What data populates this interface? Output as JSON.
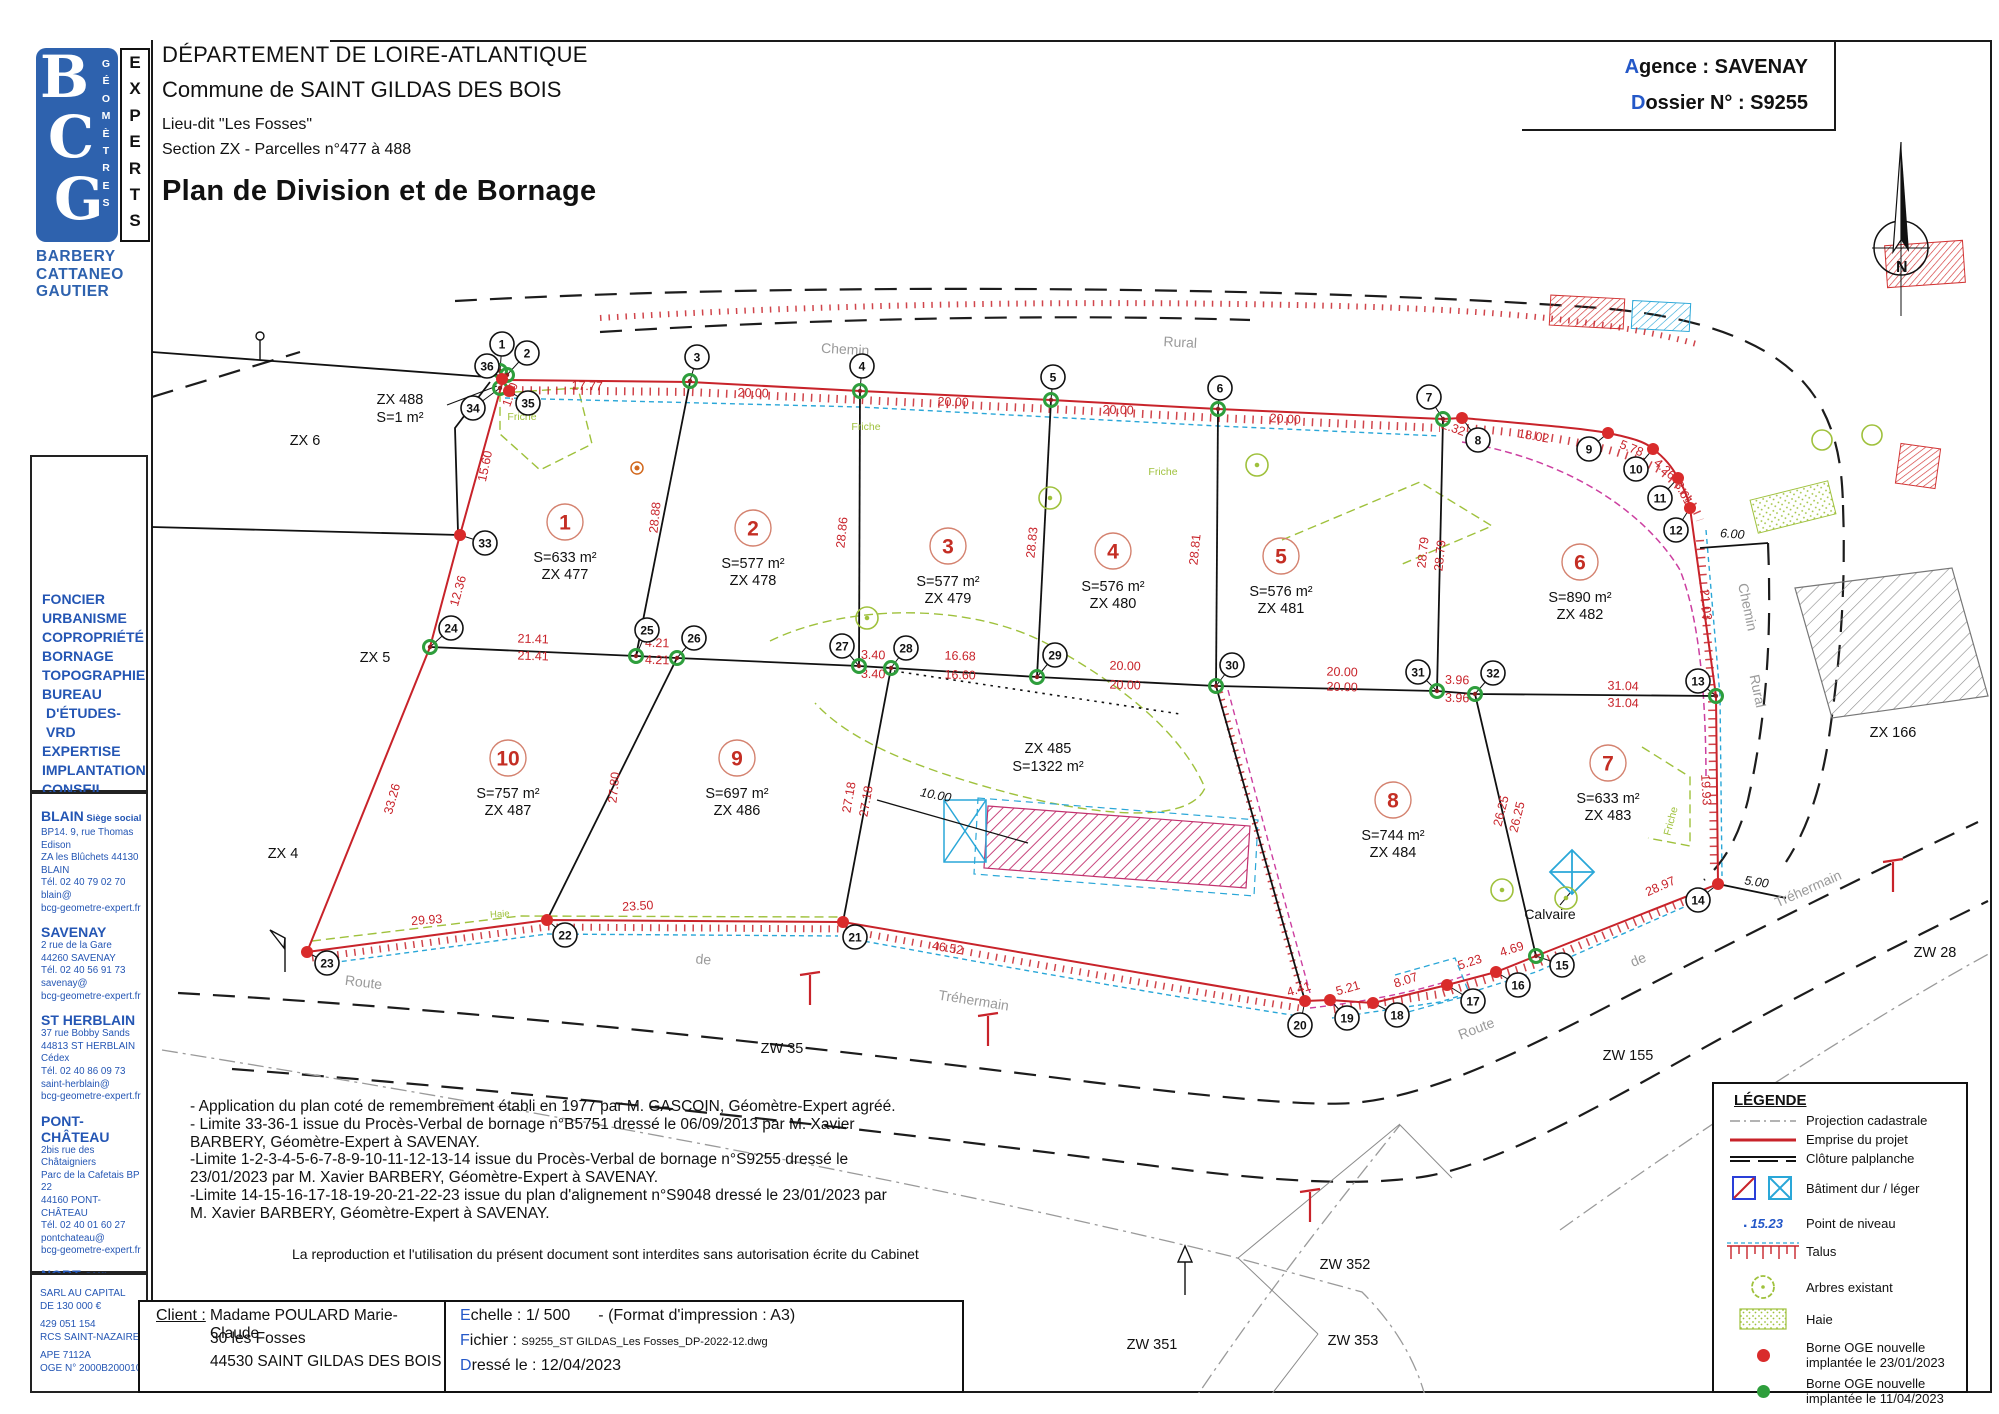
{
  "document": {
    "department": "DÉPARTEMENT DE LOIRE-ATLANTIQUE",
    "commune": "Commune de SAINT GILDAS DES BOIS",
    "lieu_dit": "Lieu-dit \"Les Fosses\"",
    "section": "Section ZX - Parcelles n°477 à 488",
    "title": "Plan de Division et de Bornage",
    "agence_label": "Agence : SAVENAY",
    "dossier_label": "Dossier N° : S9255",
    "north_letter": "N"
  },
  "logo": {
    "b": "B",
    "c": "C",
    "g": "G",
    "vertical1": "G É O M È T R E S",
    "vertical2": "E X P E R T S",
    "names": [
      "BARBERY",
      "CATTANEO",
      "GAUTIER"
    ]
  },
  "sidebar": {
    "services": [
      "FONCIER",
      "URBANISME",
      "COPROPRIÉTÉ",
      "BORNAGE",
      "TOPOGRAPHIE",
      "BUREAU",
      "D'ÉTUDES-VRD",
      "EXPERTISE",
      "IMPLANTATION",
      "CONSEIL"
    ],
    "offices": [
      {
        "name": "BLAIN",
        "suffix": " Siège social",
        "lines": [
          "BP14. 9, rue Thomas Edison",
          "ZA les Blûchets 44130 BLAIN",
          "Tél. 02 40 79 02 70",
          "blain@",
          "bcg-geometre-expert.fr"
        ]
      },
      {
        "name": "SAVENAY",
        "suffix": "",
        "lines": [
          "2 rue de la Gare",
          "44260 SAVENAY",
          "Tél. 02 40 56 91 73",
          "savenay@",
          "bcg-geometre-expert.fr"
        ]
      },
      {
        "name": "ST HERBLAIN",
        "suffix": "",
        "lines": [
          "37 rue Bobby Sands",
          "44813 ST HERBLAIN Cédex",
          "Tél. 02 40 86 09 73",
          "saint-herblain@",
          "bcg-geometre-expert.fr"
        ]
      },
      {
        "name": "PONT-CHÂTEAU",
        "suffix": "",
        "lines": [
          "2bis rue des Châtaigniers",
          "Parc de la Cafetais BP 22",
          "44160 PONT-CHÂTEAU",
          "Tél. 02 40 01 60 27",
          "pontchateau@",
          "bcg-geometre-expert.fr"
        ]
      },
      {
        "name": "NORT sur ERDRE",
        "suffix": "",
        "lines": [
          "20, rue Aristide Briand",
          "44390 NORT sur ERDRE",
          "Tél. 02 40 93 19 48",
          "nort-sur-erdre@",
          "bcg-geometre-expert.fr"
        ]
      }
    ],
    "company": [
      "SARL AU CAPITAL",
      "DE 130 000 €",
      "429 051 154",
      "RCS SAINT-NAZAIRE",
      "APE 7112A",
      "OGE N° 2000B200010"
    ]
  },
  "notes": {
    "lines": [
      "- Application du plan coté de remembrement établi en 1977 par M. GASCOIN, Géomètre-Expert agréé.",
      "- Limite 33-36-1 issue du Procès-Verbal de bornage n°B5751 dressé le 06/09/2013 par M. Xavier",
      "BARBERY, Géomètre-Expert à SAVENAY.",
      "-Limite 1-2-3-4-5-6-7-8-9-10-11-12-13-14 issue du Procès-Verbal de bornage n°S9255 dressé le",
      "23/01/2023 par M. Xavier BARBERY, Géomètre-Expert à SAVENAY.",
      "-Limite 14-15-16-17-18-19-20-21-22-23 issue du plan d'alignement n°S9048 dressé le 23/01/2023 par",
      "M. Xavier BARBERY, Géomètre-Expert à SAVENAY."
    ],
    "reproduction": "La reproduction et l'utilisation du présent document sont interdites sans autorisation écrite du Cabinet"
  },
  "footer": {
    "client_label": "Client :",
    "client_lines": [
      "Madame POULARD Marie-Claude",
      "30 les Fosses",
      "44530 SAINT GILDAS DES BOIS"
    ],
    "echelle": "Echelle : 1/ 500",
    "format": "- (Format d'impression : A3)",
    "fichier_label": "Fichier : ",
    "fichier_value": "S9255_ST GILDAS_Les Fosses_DP-2022-12.dwg",
    "dresse": "Dressé le : 12/04/2023"
  },
  "legend": {
    "title": "LÉGENDE",
    "items": [
      {
        "symbol": "cadastral-line",
        "label": "Projection cadastrale"
      },
      {
        "symbol": "project-line",
        "label": "Emprise du projet"
      },
      {
        "symbol": "palplanche-line",
        "label": "Clôture palplanche"
      },
      {
        "symbol": "building-squares",
        "label": "Bâtiment dur / léger"
      },
      {
        "symbol": "level-point",
        "label": "Point de niveau",
        "value": "15.23"
      },
      {
        "symbol": "talus",
        "label": "Talus"
      },
      {
        "symbol": "tree",
        "label": "Arbres existant"
      },
      {
        "symbol": "hedge",
        "label": "Haie"
      },
      {
        "symbol": "red-dot",
        "label": "Borne OGE nouvelle",
        "label2": "implantée le 23/01/2023"
      },
      {
        "symbol": "green-dot",
        "label": "Borne OGE nouvelle",
        "label2": "implantée le 11/04/2023"
      }
    ]
  },
  "map": {
    "parcels": [
      {
        "n": "1",
        "area": "S=633 m²",
        "ref": "ZX 477",
        "x": 565,
        "y": 522
      },
      {
        "n": "2",
        "area": "S=577 m²",
        "ref": "ZX 478",
        "x": 753,
        "y": 528
      },
      {
        "n": "3",
        "area": "S=577 m²",
        "ref": "ZX 479",
        "x": 948,
        "y": 546
      },
      {
        "n": "4",
        "area": "S=576 m²",
        "ref": "ZX 480",
        "x": 1113,
        "y": 551
      },
      {
        "n": "5",
        "area": "S=576 m²",
        "ref": "ZX 481",
        "x": 1281,
        "y": 556
      },
      {
        "n": "6",
        "area": "S=890 m²",
        "ref": "ZX 482",
        "x": 1580,
        "y": 562
      },
      {
        "n": "7",
        "area": "S=633 m²",
        "ref": "ZX 483",
        "x": 1608,
        "y": 763
      },
      {
        "n": "8",
        "area": "S=744 m²",
        "ref": "ZX 484",
        "x": 1393,
        "y": 800
      },
      {
        "n": "9",
        "area": "S=697 m²",
        "ref": "ZX 486",
        "x": 737,
        "y": 758
      },
      {
        "n": "10",
        "area": "S=757 m²",
        "ref": "ZX 487",
        "x": 508,
        "y": 758
      }
    ],
    "zones": [
      {
        "l1": "ZX 485",
        "l2": "S=1322 m²",
        "x": 1048,
        "y": 753
      },
      {
        "l1": "ZX 488",
        "l2": "S=1 m²",
        "x": 400,
        "y": 404
      }
    ],
    "points": [
      {
        "n": "1",
        "lx": 502,
        "ly": 344,
        "dx": 500,
        "dy": 371,
        "c": "g"
      },
      {
        "n": "2",
        "lx": 527,
        "ly": 353,
        "dx": 507,
        "dy": 375,
        "c": "g"
      },
      {
        "n": "3",
        "lx": 697,
        "ly": 357,
        "dx": 690,
        "dy": 381,
        "c": "g"
      },
      {
        "n": "4",
        "lx": 862,
        "ly": 366,
        "dx": 860,
        "dy": 391,
        "c": "g"
      },
      {
        "n": "5",
        "lx": 1053,
        "ly": 377,
        "dx": 1051,
        "dy": 400,
        "c": "g"
      },
      {
        "n": "6",
        "lx": 1220,
        "ly": 388,
        "dx": 1218,
        "dy": 409,
        "c": "g"
      },
      {
        "n": "7",
        "lx": 1429,
        "ly": 397,
        "dx": 1443,
        "dy": 419,
        "c": "g"
      },
      {
        "n": "8",
        "lx": 1478,
        "ly": 440,
        "dx": 1462,
        "dy": 418,
        "c": "r"
      },
      {
        "n": "9",
        "lx": 1589,
        "ly": 449,
        "dx": 1608,
        "dy": 433,
        "c": "r"
      },
      {
        "n": "10",
        "lx": 1636,
        "ly": 469,
        "dx": 1653,
        "dy": 449,
        "c": "r"
      },
      {
        "n": "11",
        "lx": 1660,
        "ly": 498,
        "dx": 1678,
        "dy": 478,
        "c": "r"
      },
      {
        "n": "12",
        "lx": 1676,
        "ly": 530,
        "dx": 1690,
        "dy": 508,
        "c": "r"
      },
      {
        "n": "13",
        "lx": 1698,
        "ly": 681,
        "dx": 1716,
        "dy": 696,
        "c": "g"
      },
      {
        "n": "14",
        "lx": 1698,
        "ly": 900,
        "dx": 1718,
        "dy": 884,
        "c": "r"
      },
      {
        "n": "15",
        "lx": 1562,
        "ly": 965,
        "dx": 1536,
        "dy": 956,
        "c": "g"
      },
      {
        "n": "16",
        "lx": 1518,
        "ly": 985,
        "dx": 1496,
        "dy": 972,
        "c": "r"
      },
      {
        "n": "17",
        "lx": 1473,
        "ly": 1001,
        "dx": 1447,
        "dy": 985,
        "c": "r"
      },
      {
        "n": "18",
        "lx": 1397,
        "ly": 1015,
        "dx": 1373,
        "dy": 1003,
        "c": "r"
      },
      {
        "n": "19",
        "lx": 1347,
        "ly": 1018,
        "dx": 1330,
        "dy": 1000,
        "c": "r"
      },
      {
        "n": "20",
        "lx": 1300,
        "ly": 1025,
        "dx": 1305,
        "dy": 1001,
        "c": "r"
      },
      {
        "n": "21",
        "lx": 855,
        "ly": 937,
        "dx": 843,
        "dy": 922,
        "c": "r"
      },
      {
        "n": "22",
        "lx": 565,
        "ly": 935,
        "dx": 547,
        "dy": 920,
        "c": "r"
      },
      {
        "n": "23",
        "lx": 327,
        "ly": 963,
        "dx": 307,
        "dy": 952,
        "c": "r"
      },
      {
        "n": "24",
        "lx": 451,
        "ly": 628,
        "dx": 430,
        "dy": 647,
        "c": "g"
      },
      {
        "n": "25",
        "lx": 647,
        "ly": 630,
        "dx": 636,
        "dy": 656,
        "c": "g"
      },
      {
        "n": "26",
        "lx": 694,
        "ly": 638,
        "dx": 677,
        "dy": 658,
        "c": "g"
      },
      {
        "n": "27",
        "lx": 842,
        "ly": 646,
        "dx": 859,
        "dy": 666,
        "c": "g"
      },
      {
        "n": "28",
        "lx": 906,
        "ly": 648,
        "dx": 891,
        "dy": 668,
        "c": "g"
      },
      {
        "n": "29",
        "lx": 1055,
        "ly": 655,
        "dx": 1037,
        "dy": 677,
        "c": "g"
      },
      {
        "n": "30",
        "lx": 1232,
        "ly": 665,
        "dx": 1216,
        "dy": 686,
        "c": "g"
      },
      {
        "n": "31",
        "lx": 1418,
        "ly": 672,
        "dx": 1437,
        "dy": 691,
        "c": "g"
      },
      {
        "n": "32",
        "lx": 1493,
        "ly": 673,
        "dx": 1475,
        "dy": 694,
        "c": "g"
      },
      {
        "n": "33",
        "lx": 485,
        "ly": 543,
        "dx": 460,
        "dy": 535,
        "c": "r"
      },
      {
        "n": "34",
        "lx": 473,
        "ly": 408,
        "dx": 500,
        "dy": 388,
        "c": "g"
      },
      {
        "n": "35",
        "lx": 528,
        "ly": 403,
        "dx": 509,
        "dy": 391,
        "c": "r"
      },
      {
        "n": "36",
        "lx": 487,
        "ly": 366,
        "dx": 502,
        "dy": 379,
        "c": "r"
      }
    ],
    "dims": [
      {
        "t": "17.77",
        "x": 587,
        "y": 390,
        "r": 2
      },
      {
        "t": "20.00",
        "x": 753,
        "y": 397,
        "r": 2
      },
      {
        "t": "20.00",
        "x": 953,
        "y": 406,
        "r": 2
      },
      {
        "t": "20.00",
        "x": 1118,
        "y": 414,
        "r": 2
      },
      {
        "t": "20.00",
        "x": 1285,
        "y": 423,
        "r": 3
      },
      {
        "t": "2.32",
        "x": 1452,
        "y": 432,
        "r": 20
      },
      {
        "t": "18.02",
        "x": 1533,
        "y": 440,
        "r": 10
      },
      {
        "t": "5.78",
        "x": 1630,
        "y": 452,
        "r": 22
      },
      {
        "t": "4.26",
        "x": 1662,
        "y": 472,
        "r": 42
      },
      {
        "t": "3.61",
        "x": 1680,
        "y": 495,
        "r": 62
      },
      {
        "t": "6.00",
        "x": 1732,
        "y": 538,
        "r": 4,
        "k": 1
      },
      {
        "t": "21.03",
        "x": 1702,
        "y": 605,
        "r": 84
      },
      {
        "t": "19.93",
        "x": 1702,
        "y": 790,
        "r": 87
      },
      {
        "t": "5.00",
        "x": 1756,
        "y": 886,
        "r": 8,
        "k": 1
      },
      {
        "t": "1.90",
        "x": 514,
        "y": 396,
        "r": -70
      },
      {
        "t": "15.60",
        "x": 489,
        "y": 467,
        "r": -78
      },
      {
        "t": "12.36",
        "x": 462,
        "y": 592,
        "r": -74
      },
      {
        "t": "33.26",
        "x": 396,
        "y": 800,
        "r": -74
      },
      {
        "t": "28.88",
        "x": 659,
        "y": 518,
        "r": -84
      },
      {
        "t": "28.86",
        "x": 846,
        "y": 533,
        "r": -84
      },
      {
        "t": "28.83",
        "x": 1036,
        "y": 543,
        "r": -84
      },
      {
        "t": "28.81",
        "x": 1199,
        "y": 550,
        "r": -84
      },
      {
        "t": "28.79",
        "x": 1427,
        "y": 553,
        "r": -84
      },
      {
        "t": "28.79",
        "x": 1444,
        "y": 556,
        "r": -84
      },
      {
        "t": "27.80",
        "x": 618,
        "y": 788,
        "r": -84
      },
      {
        "t": "27.18",
        "x": 853,
        "y": 798,
        "r": -80
      },
      {
        "t": "27.18",
        "x": 870,
        "y": 802,
        "r": -80
      },
      {
        "t": "26.25",
        "x": 1505,
        "y": 812,
        "r": -76
      },
      {
        "t": "26.25",
        "x": 1521,
        "y": 818,
        "r": -76
      },
      {
        "t": "21.41",
        "x": 533,
        "y": 643,
        "r": 2
      },
      {
        "t": "21.41",
        "x": 533,
        "y": 660,
        "r": 2
      },
      {
        "t": "4.21",
        "x": 657,
        "y": 647,
        "r": 2
      },
      {
        "t": "4.21",
        "x": 657,
        "y": 664,
        "r": 2
      },
      {
        "t": "3.40",
        "x": 873,
        "y": 659,
        "r": 2
      },
      {
        "t": "3.40",
        "x": 873,
        "y": 678,
        "r": 2
      },
      {
        "t": "16.68",
        "x": 960,
        "y": 660,
        "r": 2
      },
      {
        "t": "16.60",
        "x": 960,
        "y": 679,
        "r": 2
      },
      {
        "t": "20.00",
        "x": 1125,
        "y": 670,
        "r": 2
      },
      {
        "t": "20.00",
        "x": 1125,
        "y": 689,
        "r": 2
      },
      {
        "t": "20.00",
        "x": 1342,
        "y": 676,
        "r": 2
      },
      {
        "t": "20.00",
        "x": 1342,
        "y": 691,
        "r": 2
      },
      {
        "t": "3.96",
        "x": 1457,
        "y": 684,
        "r": 2
      },
      {
        "t": "3.96",
        "x": 1457,
        "y": 702,
        "r": 2
      },
      {
        "t": "31.04",
        "x": 1623,
        "y": 690,
        "r": 2
      },
      {
        "t": "31.04",
        "x": 1623,
        "y": 707,
        "r": 2
      },
      {
        "t": "10.00",
        "x": 935,
        "y": 799,
        "r": 11,
        "k": 1
      },
      {
        "t": "29.93",
        "x": 427,
        "y": 924,
        "r": -4
      },
      {
        "t": "23.50",
        "x": 638,
        "y": 910,
        "r": -3
      },
      {
        "t": "46.52",
        "x": 947,
        "y": 952,
        "r": 9
      },
      {
        "t": "4.41",
        "x": 1300,
        "y": 993,
        "r": -17
      },
      {
        "t": "5.21",
        "x": 1349,
        "y": 992,
        "r": -16
      },
      {
        "t": "8.07",
        "x": 1407,
        "y": 984,
        "r": -18
      },
      {
        "t": "5.23",
        "x": 1471,
        "y": 966,
        "r": -18
      },
      {
        "t": "4.69",
        "x": 1513,
        "y": 953,
        "r": -18
      },
      {
        "t": "28.97",
        "x": 1662,
        "y": 890,
        "r": -24
      }
    ],
    "labels": [
      {
        "t": "ZX 6",
        "x": 305,
        "y": 445,
        "r": 0,
        "c": "n"
      },
      {
        "t": "ZX 5",
        "x": 375,
        "y": 662,
        "r": 0,
        "c": "n"
      },
      {
        "t": "ZX 4",
        "x": 283,
        "y": 858,
        "r": 0,
        "c": "n"
      },
      {
        "t": "ZX 166",
        "x": 1893,
        "y": 737,
        "r": 0,
        "c": "n"
      },
      {
        "t": "ZW 28",
        "x": 1935,
        "y": 957,
        "r": 0,
        "c": "n"
      },
      {
        "t": "ZW 35",
        "x": 782,
        "y": 1053,
        "r": 0,
        "c": "n"
      },
      {
        "t": "ZW 155",
        "x": 1628,
        "y": 1060,
        "r": 0,
        "c": "n"
      },
      {
        "t": "ZW 352",
        "x": 1345,
        "y": 1269,
        "r": 0,
        "c": "n"
      },
      {
        "t": "ZW 351",
        "x": 1152,
        "y": 1349,
        "r": 0,
        "c": "n"
      },
      {
        "t": "ZW 353",
        "x": 1353,
        "y": 1345,
        "r": 0,
        "c": "n"
      },
      {
        "t": "Chemin",
        "x": 845,
        "y": 354,
        "r": 3,
        "c": "rd"
      },
      {
        "t": "Rural",
        "x": 1180,
        "y": 347,
        "r": 3,
        "c": "rd"
      },
      {
        "t": "Chemin",
        "x": 1743,
        "y": 608,
        "r": 78,
        "c": "rd"
      },
      {
        "t": "Rural",
        "x": 1753,
        "y": 692,
        "r": 78,
        "c": "rd"
      },
      {
        "t": "Route",
        "x": 363,
        "y": 987,
        "r": 7,
        "c": "rd"
      },
      {
        "t": "de",
        "x": 703,
        "y": 964,
        "r": 5,
        "c": "rd"
      },
      {
        "t": "Tréhermain",
        "x": 973,
        "y": 1005,
        "r": 9,
        "c": "rd"
      },
      {
        "t": "Route",
        "x": 1478,
        "y": 1033,
        "r": -21,
        "c": "rd"
      },
      {
        "t": "de",
        "x": 1640,
        "y": 964,
        "r": -23,
        "c": "rd"
      },
      {
        "t": "Tréhermain",
        "x": 1810,
        "y": 893,
        "r": -24,
        "c": "rd"
      },
      {
        "t": "Friche",
        "x": 522,
        "y": 420,
        "r": 0,
        "c": "f"
      },
      {
        "t": "Friche",
        "x": 866,
        "y": 430,
        "r": 0,
        "c": "f"
      },
      {
        "t": "Friche",
        "x": 1163,
        "y": 475,
        "r": 0,
        "c": "f"
      },
      {
        "t": "Friche",
        "x": 1674,
        "y": 822,
        "r": -75,
        "c": "f"
      },
      {
        "t": "Haie",
        "x": 500,
        "y": 917,
        "r": -4,
        "c": "h"
      },
      {
        "t": "Calvaire",
        "x": 1550,
        "y": 919,
        "r": 0,
        "c": "c"
      }
    ]
  }
}
